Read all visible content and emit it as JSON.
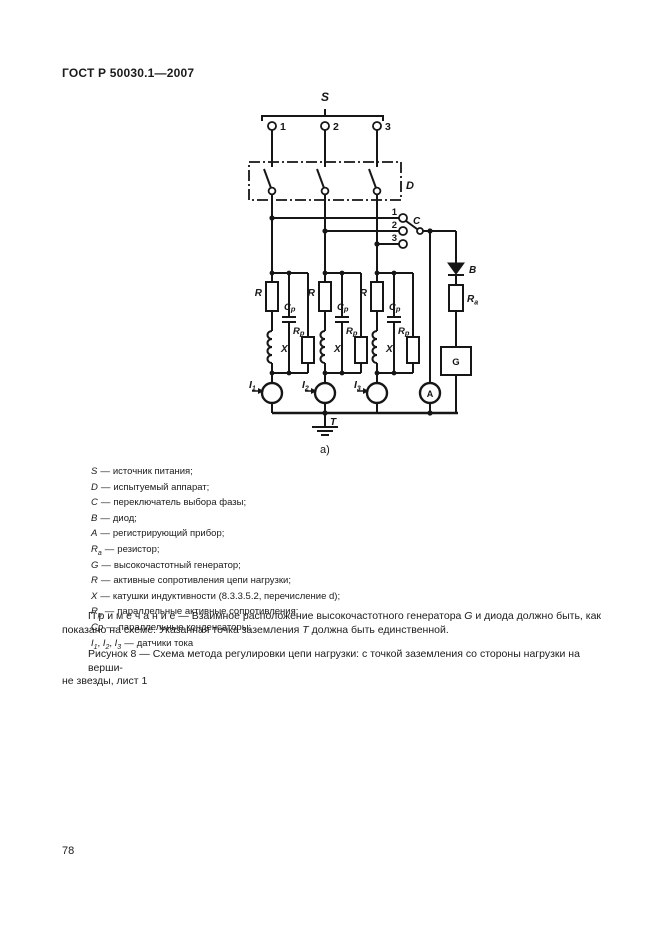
{
  "page": {
    "header": "ГОСТ Р 50030.1—2007",
    "page_number": "78"
  },
  "diagram": {
    "source_label": "S",
    "terminal_labels": [
      "1",
      "2",
      "3"
    ],
    "device_label": "D",
    "selector_contact_labels": [
      "1",
      "2",
      "3"
    ],
    "selector_label": "C",
    "diode_label": "B",
    "resistor_label": {
      "sym": "R",
      "sub": "а"
    },
    "generator_label": "G",
    "meter_label": "A",
    "load_resistor_label": "R",
    "inductor_label": "X",
    "parallel_capacitor_label": {
      "sym": "C",
      "sub": "p"
    },
    "parallel_resistor_label": {
      "sym": "R",
      "sub": "p"
    },
    "sensor_labels": [
      {
        "sym": "I",
        "sub": "1"
      },
      {
        "sym": "I",
        "sub": "2"
      },
      {
        "sym": "I",
        "sub": "3"
      }
    ],
    "ground_label": "T",
    "sublabel": "а)"
  },
  "legend": {
    "dash": "—",
    "items": [
      {
        "sym": "S",
        "sub": "",
        "text": "источник питания;"
      },
      {
        "sym": "D",
        "sub": "",
        "text": "испытуемый аппарат;"
      },
      {
        "sym": "C",
        "sub": "",
        "text": "переключатель выбора фазы;"
      },
      {
        "sym": "B",
        "sub": "",
        "text": "диод;"
      },
      {
        "sym": "A",
        "sub": "",
        "text": "регистрирующий прибор;"
      },
      {
        "sym": "R",
        "sub": "а",
        "text": "резистор;"
      },
      {
        "sym": "G",
        "sub": "",
        "text": "высокочастотный генератор;"
      },
      {
        "sym": "R",
        "sub": "",
        "text": "активные сопротивления цепи нагрузки;"
      },
      {
        "sym": "X",
        "sub": "",
        "text": "катушки индуктивности (8.3.3.5.2, перечисление d);"
      },
      {
        "sym": "R",
        "sub": "p",
        "text": "параллельные активные сопротивления;"
      },
      {
        "sym": "Cp",
        "sub": "",
        "text": "параллельные конденсаторы;"
      }
    ],
    "sensors": {
      "sym": "I",
      "sub1": "1",
      "sub2": "2",
      "sub3": "3",
      "sep": ", ",
      "text": "датчики тока"
    }
  },
  "note": {
    "line1_pre": "П р и м е ч а н и е — Взаимное расположение высокочастотного генератора ",
    "line1_sym": "G",
    "line1_post": " и диода должно быть, как",
    "line2_pre": "показано на схеме. Указанная точка заземления ",
    "line2_sym": "Т",
    "line2_post": " должна быть единственной."
  },
  "caption": {
    "line1": "Рисунок 8 — Схема метода регулировки цепи нагрузки: с точкой заземления со стороны нагрузки на верши-",
    "line2": "не звезды, лист 1"
  }
}
